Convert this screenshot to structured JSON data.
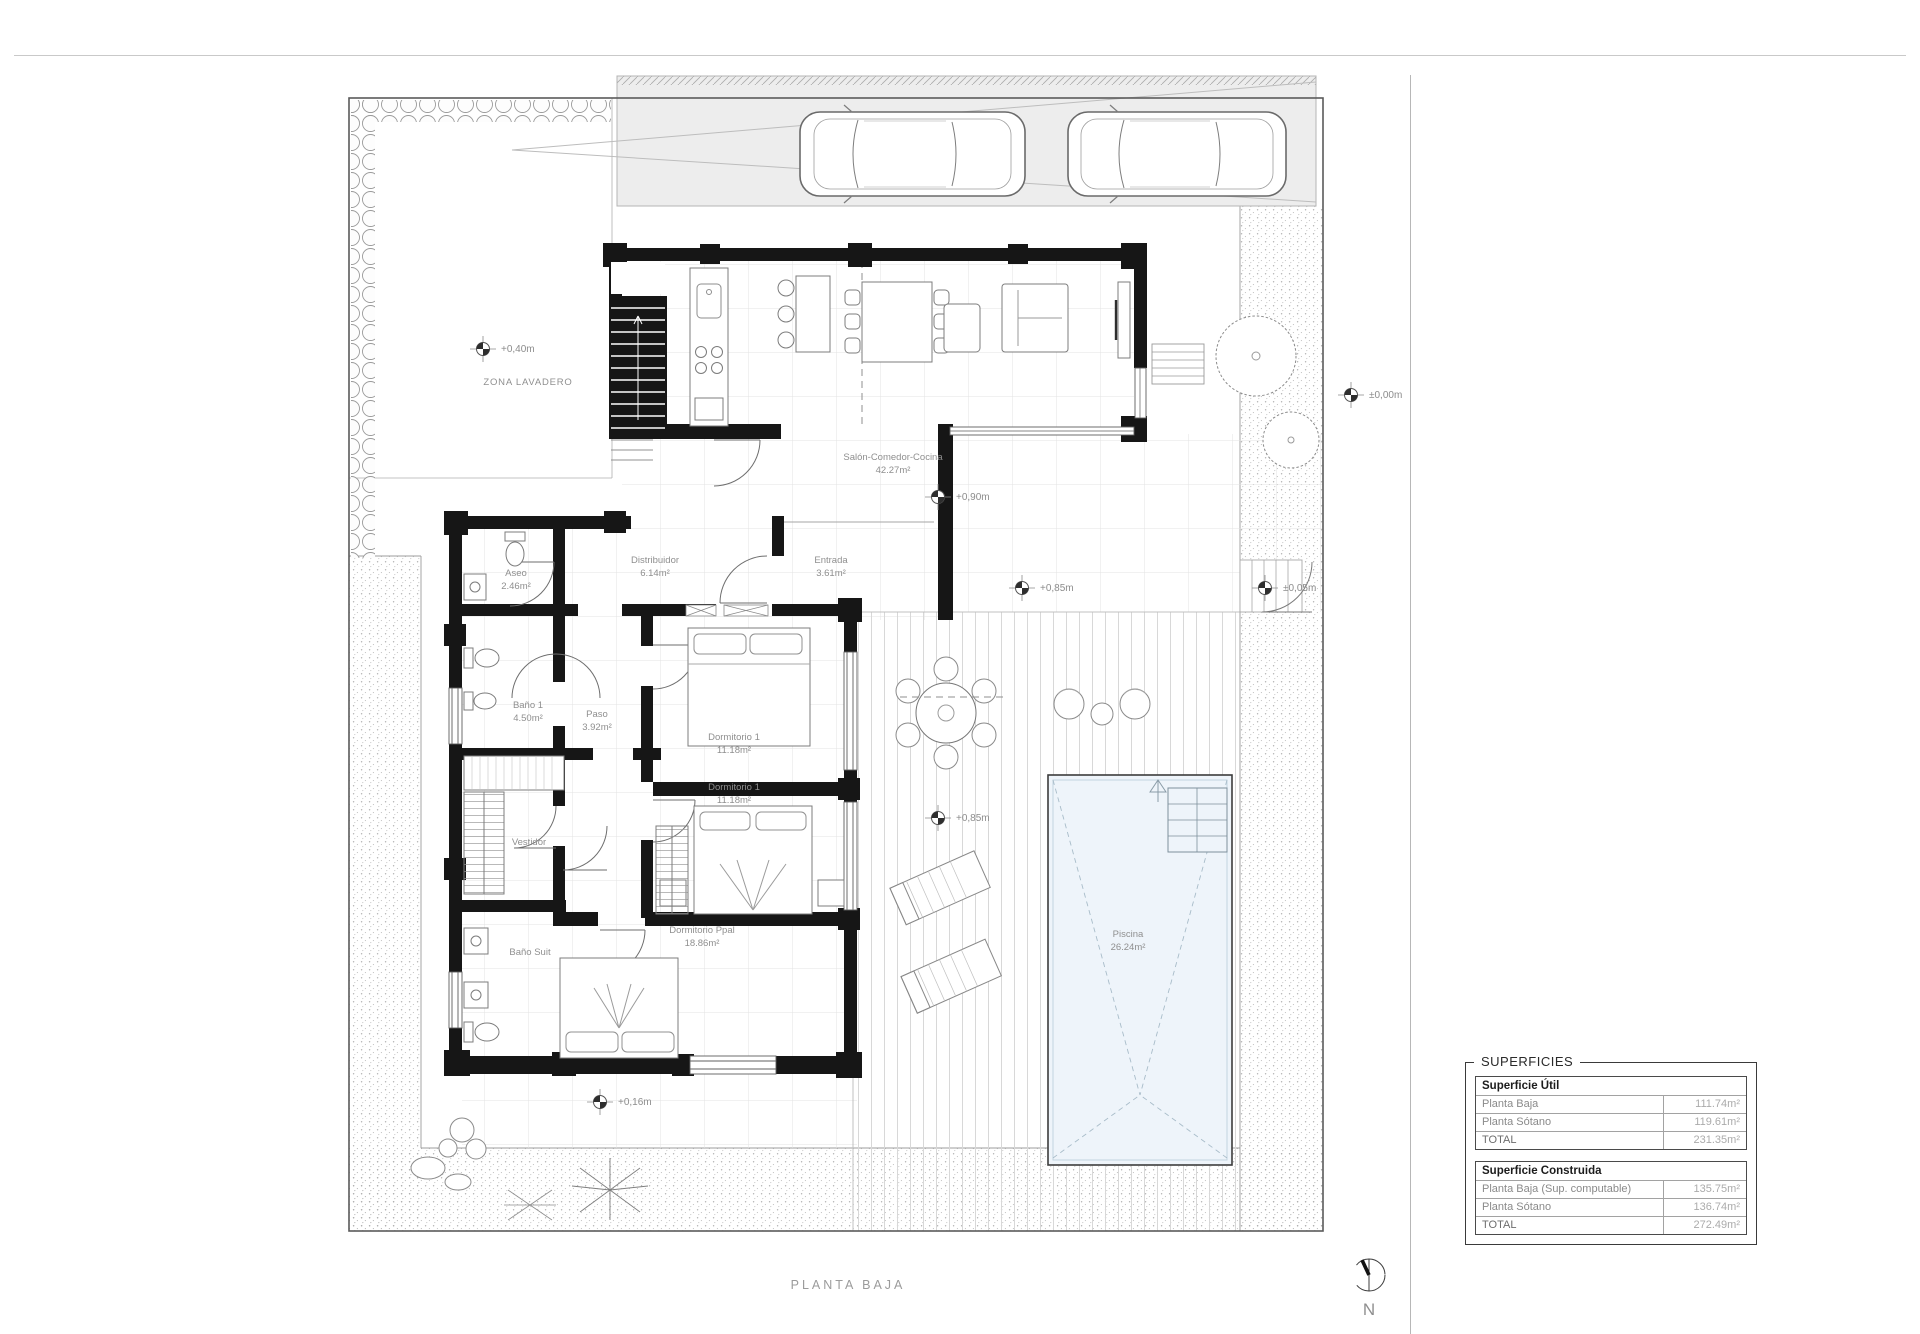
{
  "drawing": {
    "title": "PLANTA BAJA",
    "north_label": "N",
    "zone_label": "ZONA LAVADERO"
  },
  "rooms": [
    {
      "name": "Salón-Comedor-Cocina",
      "area": "42.27m²"
    },
    {
      "name": "Distribuidor",
      "area": "6.14m²"
    },
    {
      "name": "Entrada",
      "area": "3.61m²"
    },
    {
      "name": "Aseo",
      "area": "2.46m²"
    },
    {
      "name": "Baño 1",
      "area": "4.50m²"
    },
    {
      "name": "Paso",
      "area": "3.92m²"
    },
    {
      "name": "Dormitorio 1",
      "area": "11.18m²"
    },
    {
      "name": "Dormitorio 1",
      "area": "11.18m²"
    },
    {
      "name": "Vestidor",
      "area": ""
    },
    {
      "name": "Baño Suit",
      "area": ""
    },
    {
      "name": "Dormitorio Ppal",
      "area": "18.86m²"
    },
    {
      "name": "Piscina",
      "area": "26.24m²"
    }
  ],
  "levels": [
    {
      "text": "+0,40m"
    },
    {
      "text": "+0,90m"
    },
    {
      "text": "+0,85m"
    },
    {
      "text": "+0,85m"
    },
    {
      "text": "±0,00m"
    },
    {
      "text": "±0,05m"
    },
    {
      "text": "+0,16m"
    }
  ],
  "summary_table": {
    "title": "SUPERFICIES",
    "sections": [
      {
        "header": "Superficie Útil",
        "rows": [
          [
            "Planta Baja",
            "111.74m²"
          ],
          [
            "Planta Sótano",
            "119.61m²"
          ],
          [
            "TOTAL",
            "231.35m²"
          ]
        ]
      },
      {
        "header": "Superficie Construida",
        "rows": [
          [
            "Planta Baja (Sup. computable)",
            "135.75m²"
          ],
          [
            "Planta Sótano",
            "136.74m²"
          ],
          [
            "TOTAL",
            "272.49m²"
          ]
        ]
      }
    ]
  }
}
